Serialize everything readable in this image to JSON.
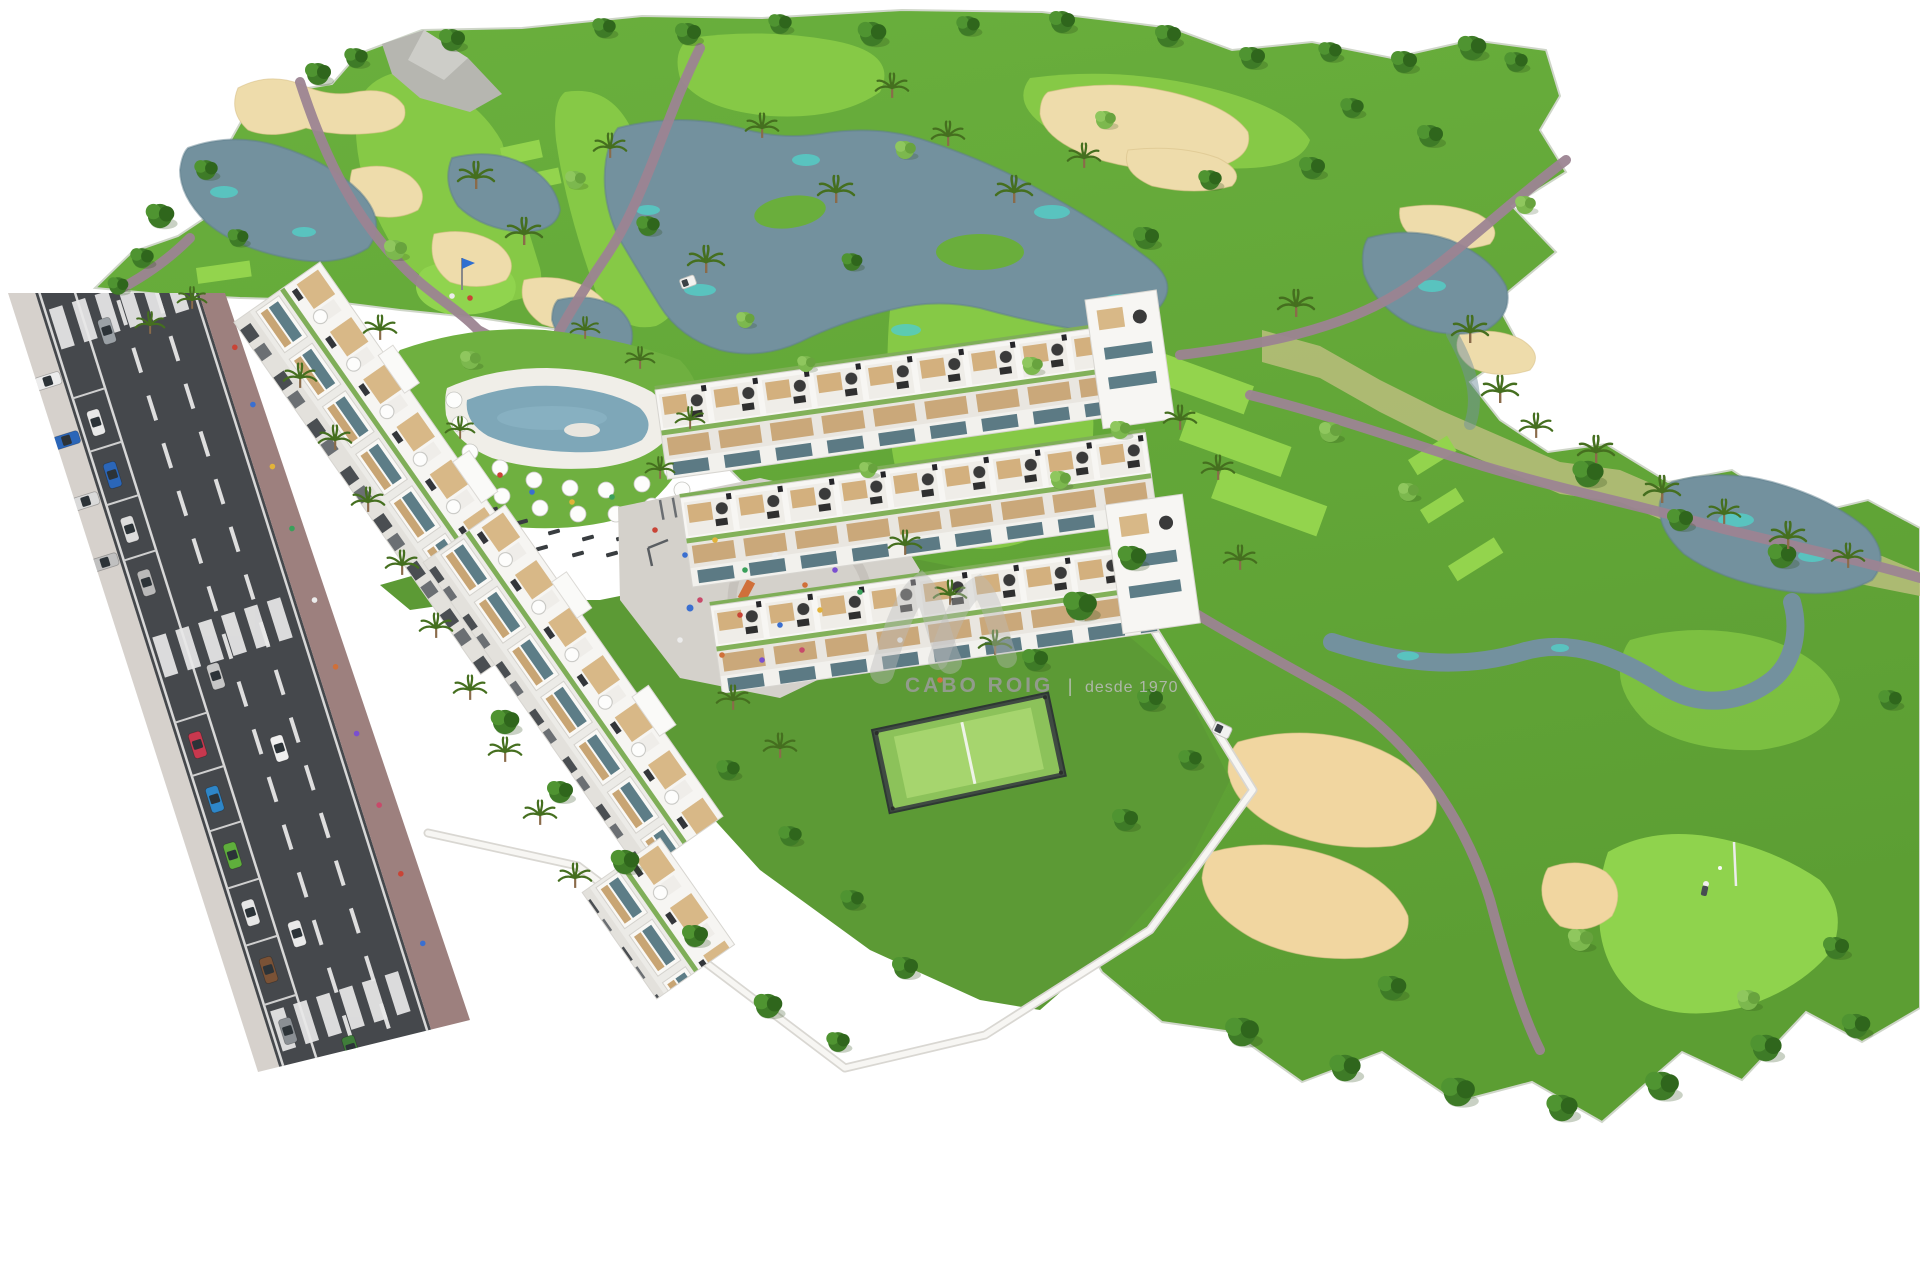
{
  "watermark": {
    "brand": "CABO ROIG",
    "separator": "|",
    "tagline": "desde 1970"
  },
  "palette": {
    "background": "#ffffff",
    "rough_green": "#66a93a",
    "fairway_green": "#86c946",
    "tee_green": "#93d44d",
    "lake_blue": "#73919e",
    "lake_teal": "#55cbc4",
    "sand": "#eedcab",
    "sand_bright": "#f1d6a0",
    "cart_path": "#9c8492",
    "road_asphalt": "#45484c",
    "road_marking": "#e6e6e6",
    "sidewalk_brick": "#9d807e",
    "building_white": "#f6f5f2",
    "wood_accent": "#cfae7e",
    "glass": "#5d7d87",
    "pool_water": "#7ea7b8",
    "court_green": "#8cc25a",
    "plaza_gray": "#d4d1cb",
    "watermark_gray": "#9c9c9c"
  },
  "scene": {
    "people_colors": [
      "#c94436",
      "#3a6fd0",
      "#e2b33a",
      "#3aa05a",
      "#ececec",
      "#d07039",
      "#7a4fd0",
      "#c84a6a"
    ],
    "trees_dark": [
      [
        318,
        74,
        1
      ],
      [
        356,
        58,
        0.9
      ],
      [
        452,
        40,
        1
      ],
      [
        604,
        28,
        0.9
      ],
      [
        688,
        34,
        1
      ],
      [
        780,
        24,
        0.9
      ],
      [
        872,
        34,
        1.1
      ],
      [
        968,
        26,
        0.9
      ],
      [
        1062,
        22,
        1
      ],
      [
        1168,
        36,
        1
      ],
      [
        1252,
        58,
        1
      ],
      [
        1330,
        52,
        0.9
      ],
      [
        1404,
        62,
        1
      ],
      [
        1472,
        48,
        1.1
      ],
      [
        1516,
        62,
        0.9
      ],
      [
        160,
        216,
        1.1
      ],
      [
        142,
        258,
        0.9
      ],
      [
        206,
        170,
        0.9
      ],
      [
        238,
        238,
        0.8
      ],
      [
        118,
        286,
        0.8
      ],
      [
        648,
        226,
        0.9
      ],
      [
        852,
        262,
        0.8
      ],
      [
        1146,
        238,
        1
      ],
      [
        1210,
        180,
        0.9
      ],
      [
        1312,
        168,
        1
      ],
      [
        1352,
        108,
        0.9
      ],
      [
        1430,
        136,
        1
      ],
      [
        1588,
        474,
        1.2
      ],
      [
        1680,
        520,
        1
      ],
      [
        1782,
        556,
        1.1
      ],
      [
        1132,
        558,
        1.1
      ],
      [
        1080,
        606,
        1.3
      ],
      [
        1035,
        660,
        1
      ],
      [
        1242,
        1032,
        1.3
      ],
      [
        1345,
        1068,
        1.2
      ],
      [
        1458,
        1092,
        1.3
      ],
      [
        1562,
        1108,
        1.2
      ],
      [
        1662,
        1086,
        1.3
      ],
      [
        1766,
        1048,
        1.2
      ],
      [
        1856,
        1026,
        1.1
      ],
      [
        505,
        722,
        1.1
      ],
      [
        560,
        792,
        1
      ],
      [
        625,
        862,
        1.1
      ],
      [
        695,
        936,
        1
      ],
      [
        768,
        1006,
        1.1
      ],
      [
        838,
        1042,
        0.9
      ],
      [
        905,
        968,
        1
      ],
      [
        852,
        900,
        0.9
      ],
      [
        790,
        836,
        0.9
      ],
      [
        728,
        770,
        0.9
      ],
      [
        1392,
        988,
        1.1
      ],
      [
        1836,
        948,
        1
      ],
      [
        1890,
        700,
        0.9
      ],
      [
        1150,
        700,
        1
      ],
      [
        1190,
        760,
        0.9
      ],
      [
        1125,
        820,
        1
      ]
    ],
    "trees_light": [
      [
        395,
        250,
        1
      ],
      [
        575,
        180,
        0.9
      ],
      [
        905,
        150,
        0.9
      ],
      [
        1105,
        120,
        0.9
      ],
      [
        470,
        360,
        0.9
      ],
      [
        1525,
        205,
        0.9
      ],
      [
        806,
        364,
        0.8
      ],
      [
        1330,
        432,
        1
      ],
      [
        1408,
        492,
        0.9
      ],
      [
        745,
        320,
        0.8
      ],
      [
        1032,
        366,
        0.9
      ],
      [
        1580,
        940,
        1.1
      ],
      [
        1748,
        1000,
        1
      ],
      [
        868,
        470,
        0.8
      ],
      [
        1060,
        480,
        0.9
      ],
      [
        1120,
        430,
        0.9
      ]
    ],
    "palms": [
      [
        476,
        178,
        1
      ],
      [
        524,
        234,
        1
      ],
      [
        610,
        148,
        0.9
      ],
      [
        706,
        262,
        1
      ],
      [
        762,
        128,
        0.9
      ],
      [
        836,
        192,
        1
      ],
      [
        948,
        136,
        0.9
      ],
      [
        1014,
        192,
        1
      ],
      [
        1084,
        158,
        0.9
      ],
      [
        892,
        88,
        0.9
      ],
      [
        1470,
        332,
        1
      ],
      [
        1500,
        392,
        1
      ],
      [
        1536,
        428,
        0.9
      ],
      [
        1596,
        452,
        1
      ],
      [
        1662,
        492,
        1
      ],
      [
        1724,
        514,
        0.9
      ],
      [
        1788,
        538,
        1
      ],
      [
        1848,
        558,
        0.9
      ],
      [
        1296,
        306,
        1
      ],
      [
        380,
        330,
        0.9
      ],
      [
        300,
        378,
        0.9
      ],
      [
        335,
        440,
        0.9
      ],
      [
        368,
        502,
        0.9
      ],
      [
        402,
        565,
        0.9
      ],
      [
        436,
        628,
        0.9
      ],
      [
        470,
        690,
        0.9
      ],
      [
        505,
        752,
        0.9
      ],
      [
        540,
        815,
        0.9
      ],
      [
        575,
        878,
        0.9
      ],
      [
        690,
        420,
        0.8
      ],
      [
        660,
        470,
        0.8
      ],
      [
        905,
        545,
        0.9
      ],
      [
        950,
        595,
        0.9
      ],
      [
        995,
        645,
        0.9
      ],
      [
        733,
        700,
        0.9
      ],
      [
        780,
        748,
        0.9
      ],
      [
        460,
        430,
        0.8
      ],
      [
        585,
        330,
        0.8
      ],
      [
        640,
        360,
        0.8
      ],
      [
        1240,
        560,
        0.9
      ],
      [
        1180,
        420,
        0.9
      ],
      [
        1218,
        470,
        0.9
      ],
      [
        150,
        325,
        0.8
      ],
      [
        192,
        300,
        0.8
      ]
    ],
    "parked_cars": [
      {
        "y": 150,
        "c": "#e8e8e8"
      },
      {
        "y": 205,
        "c": "#2b66b8"
      },
      {
        "y": 262,
        "c": "#dcdcdc"
      },
      {
        "y": 318,
        "c": "#b9b9b9"
      },
      {
        "y": 488,
        "c": "#c8384e"
      },
      {
        "y": 545,
        "c": "#2e86c8"
      },
      {
        "y": 604,
        "c": "#5fae3c"
      },
      {
        "y": 664,
        "c": "#e6e6e6"
      },
      {
        "y": 724,
        "c": "#7a5236"
      },
      {
        "y": 788,
        "c": "#8a8f94"
      }
    ],
    "apron_cars": [
      {
        "y": 96,
        "c": "#ececec"
      },
      {
        "y": 158,
        "c": "#2b66b8"
      },
      {
        "y": 222,
        "c": "#dadada"
      },
      {
        "y": 286,
        "c": "#c0c0c0"
      }
    ],
    "moving_cars": [
      {
        "x": 83,
        "y": 66,
        "c": "#9aa0a5"
      },
      {
        "x": 83,
        "y": 428,
        "c": "#c6c6c6"
      },
      {
        "x": 122,
        "y": 516,
        "c": "#efefef"
      },
      {
        "x": 83,
        "y": 698,
        "c": "#e9e9e9"
      },
      {
        "x": 100,
        "y": 824,
        "c": "#3f7d3a"
      },
      {
        "x": 160,
        "y": 906,
        "c": "#2c3e70"
      }
    ],
    "sidewalk_people": [
      120,
      180,
      245,
      310,
      385,
      455,
      525,
      600,
      672,
      745
    ],
    "plaza_people": [
      [
        655,
        530
      ],
      [
        685,
        555
      ],
      [
        715,
        540
      ],
      [
        745,
        570
      ],
      [
        775,
        555
      ],
      [
        805,
        585
      ],
      [
        835,
        570
      ],
      [
        700,
        600
      ],
      [
        740,
        615
      ],
      [
        780,
        625
      ],
      [
        820,
        610
      ],
      [
        860,
        592
      ],
      [
        680,
        640
      ],
      [
        722,
        655
      ],
      [
        762,
        660
      ],
      [
        802,
        650
      ],
      [
        500,
        475
      ],
      [
        532,
        492
      ],
      [
        572,
        502
      ],
      [
        612,
        497
      ],
      [
        900,
        640
      ],
      [
        940,
        680
      ]
    ],
    "parasols": [
      [
        470,
        452
      ],
      [
        500,
        468
      ],
      [
        534,
        480
      ],
      [
        570,
        488
      ],
      [
        606,
        490
      ],
      [
        642,
        484
      ],
      [
        672,
        470
      ],
      [
        466,
        478
      ],
      [
        502,
        496
      ],
      [
        540,
        508
      ],
      [
        578,
        514
      ],
      [
        616,
        514
      ],
      [
        652,
        506
      ],
      [
        682,
        490
      ],
      [
        460,
        424
      ],
      [
        454,
        400
      ]
    ],
    "loungers": [
      [
        492,
        510
      ],
      [
        522,
        522
      ],
      [
        554,
        532
      ],
      [
        588,
        538
      ],
      [
        622,
        538
      ],
      [
        654,
        530
      ],
      [
        682,
        516
      ],
      [
        542,
        548
      ],
      [
        578,
        554
      ],
      [
        612,
        554
      ]
    ]
  }
}
